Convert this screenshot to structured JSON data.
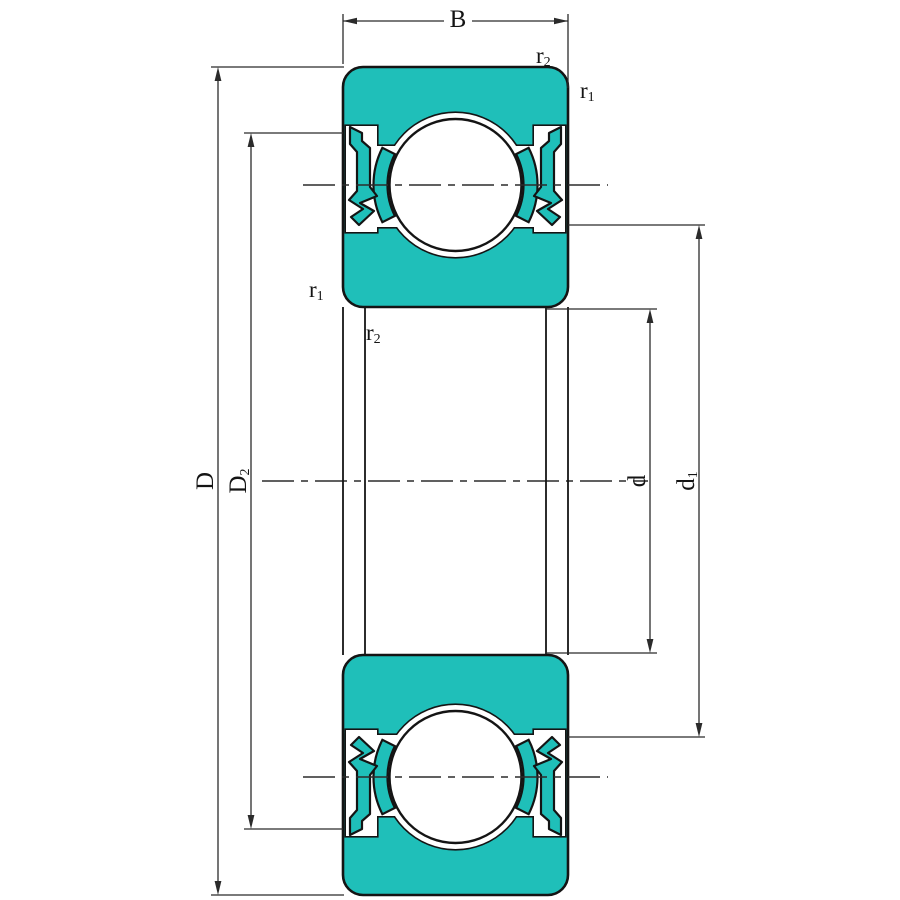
{
  "figure_title": "sealed-deep-groove-ball-bearing-cross-section",
  "colors": {
    "teal": "#1FBFB9",
    "outline": "#141414",
    "dimension_line": "#2b2b2b",
    "background": "#ffffff"
  },
  "labels": {
    "B": {
      "base": "B",
      "sub": ""
    },
    "D": {
      "base": "D",
      "sub": ""
    },
    "D2": {
      "base": "D",
      "sub": "2"
    },
    "d": {
      "base": "d",
      "sub": ""
    },
    "d1": {
      "base": "d",
      "sub": "1"
    },
    "r2_top": {
      "base": "r",
      "sub": "2"
    },
    "r1_top": {
      "base": "r",
      "sub": "1"
    },
    "r1_mid": {
      "base": "r",
      "sub": "1"
    },
    "r2_mid": {
      "base": "r",
      "sub": "2"
    }
  }
}
